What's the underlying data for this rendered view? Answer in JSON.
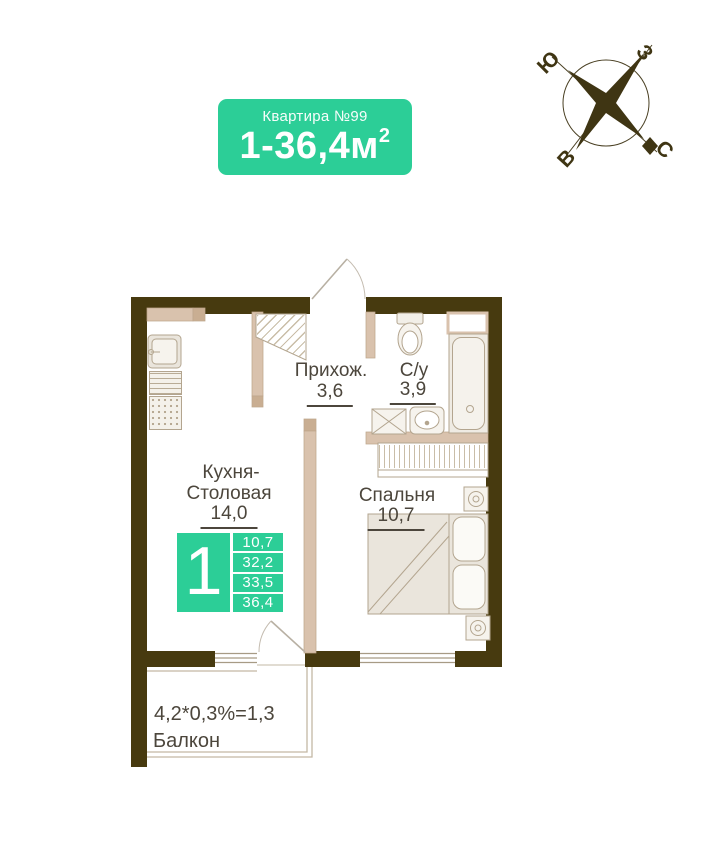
{
  "badge": {
    "title": "Квартира №99",
    "area_value": "1-36,4м",
    "area_sup": "2"
  },
  "compass": {
    "south": "Ю",
    "west": "З",
    "east": "В",
    "north": "С"
  },
  "info_box": {
    "big_number": "1",
    "areas": [
      "10,7",
      "32,2",
      "33,5",
      "36,4"
    ]
  },
  "rooms": {
    "hallway": {
      "name": "Прихож.",
      "area": "3,6"
    },
    "bathroom": {
      "name": "С/у",
      "area": "3,9"
    },
    "kitchen": {
      "name_line1": "Кухня-",
      "name_line2": "Столовая",
      "area": "14,0"
    },
    "bedroom": {
      "name": "Спальня",
      "area": "10,7"
    },
    "balcony": {
      "formula": "4,2*0,3%=1,3",
      "name": "Балкон"
    }
  },
  "colors": {
    "accent_green": "#2cce97",
    "wall_dark": "#473a0f",
    "partition_tan": "#d9c2ad",
    "label_text": "#4c463c"
  }
}
